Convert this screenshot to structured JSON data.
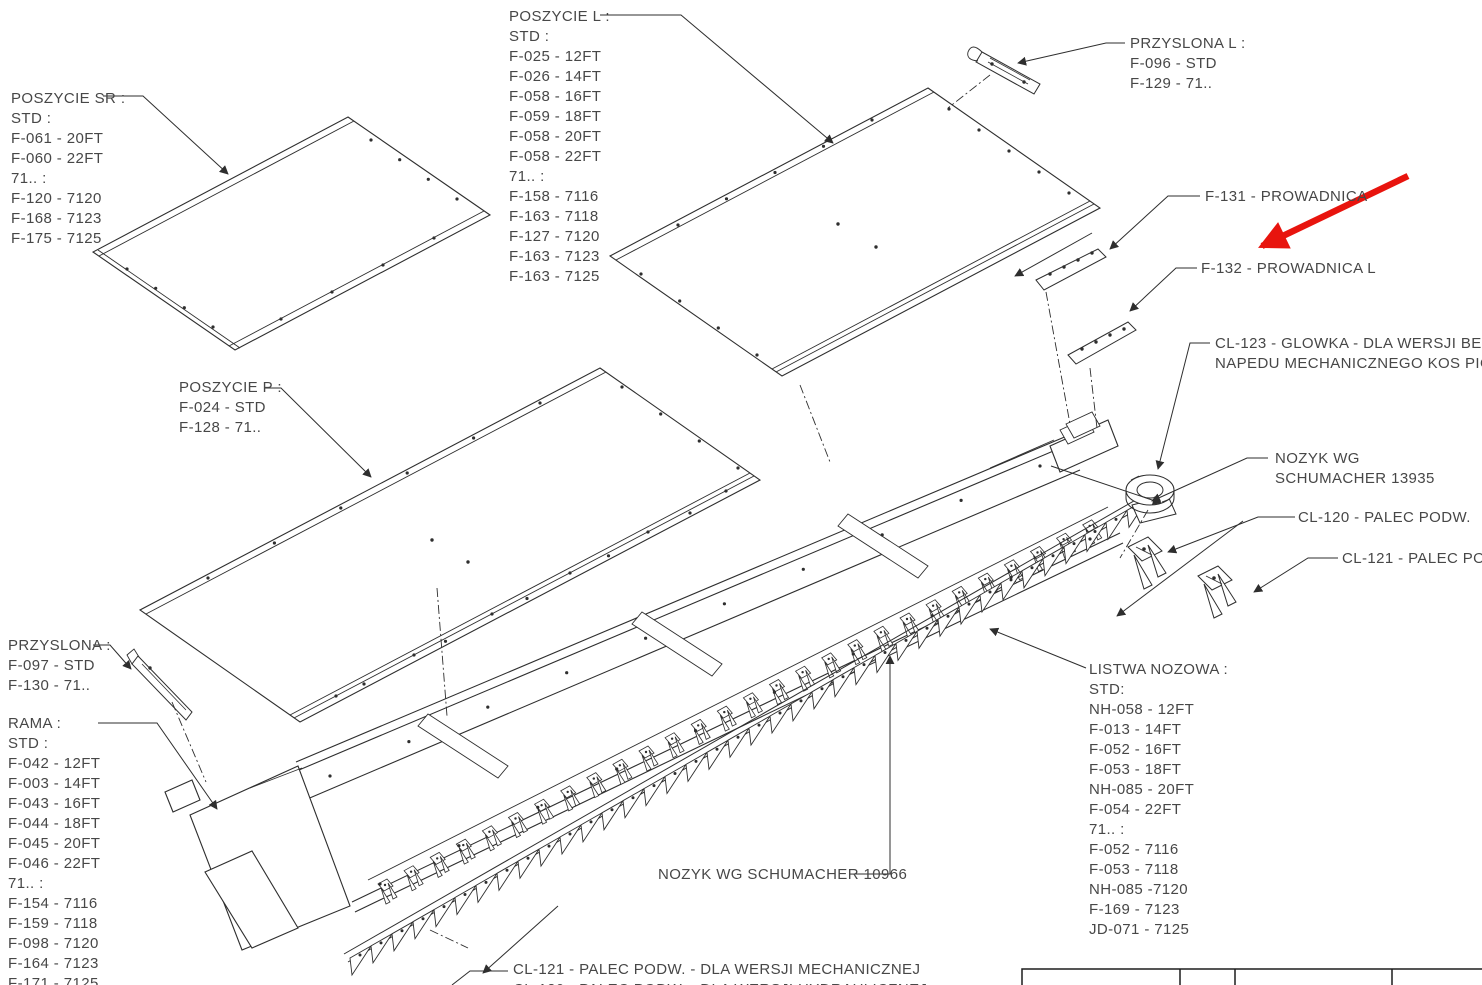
{
  "colors": {
    "line": "#2e2e2e",
    "text": "#474747",
    "highlight_red": "#e8140e",
    "background": "#ffffff"
  },
  "annotation": {
    "red_arrow": "highlight-arrow",
    "points_to": "F-132 - PROWADNICA L"
  },
  "labels": {
    "poszycie_sr": [
      "POSZYCIE SR :",
      "STD :",
      "F-061 - 20FT",
      "F-060 - 22FT",
      "71.. :",
      "F-120 - 7120",
      "F-168 - 7123",
      "F-175 - 7125"
    ],
    "poszycie_l": [
      "POSZYCIE L :",
      "STD :",
      "F-025 - 12FT",
      "F-026 - 14FT",
      "F-058 - 16FT",
      "F-059 - 18FT",
      "F-058 - 20FT",
      "F-058 - 22FT",
      "71.. :",
      "F-158 - 7116",
      "F-163 - 7118",
      "F-127 - 7120",
      "F-163 - 7123",
      "F-163 - 7125"
    ],
    "przyslona_l": [
      "PRZYSLONA L :",
      "F-096 - STD",
      "F-129 - 71.."
    ],
    "f131": [
      "F-131 - PROWADNICA"
    ],
    "f132": [
      "F-132 - PROWADNICA L"
    ],
    "cl123": [
      "CL-123 - GLOWKA - DLA WERSJI BEZ",
      "NAPEDU MECHANICZNEGO KOS PIONOWYCH"
    ],
    "nozyk_13935": [
      "NOZYK WG",
      "SCHUMACHER 13935"
    ],
    "cl120": [
      "CL-120 - PALEC PODW."
    ],
    "cl121": [
      "CL-121 - PALEC PODW."
    ],
    "poszycie_p": [
      "POSZYCIE P :",
      "F-024 - STD",
      "F-128 - 71.."
    ],
    "przyslona": [
      "PRZYSLONA :",
      "F-097 - STD",
      "F-130 - 71.."
    ],
    "rama": [
      "RAMA :",
      "STD :",
      "F-042 - 12FT",
      "F-003 - 14FT",
      "F-043 - 16FT",
      "F-044 - 18FT",
      "F-045 - 20FT",
      "F-046 - 22FT",
      "71.. :",
      "F-154 - 7116",
      "F-159 - 7118",
      "F-098 - 7120",
      "F-164 - 7123",
      "F-171 - 7125"
    ],
    "listwa_nozowa": [
      "LISTWA NOZOWA :",
      "STD:",
      "NH-058 - 12FT",
      "F-013 - 14FT",
      "F-052 - 16FT",
      "F-053 - 18FT",
      "NH-085 - 20FT",
      "F-054 - 22FT",
      "71.. :",
      "F-052 - 7116",
      "F-053 - 7118",
      "NH-085 -7120",
      "F-169 - 7123",
      "JD-071 - 7125"
    ],
    "nozyk_10966": [
      "NOZYK WG SCHUMACHER 10966"
    ],
    "cl121_bottom": [
      "CL-121 - PALEC PODW. - DLA WERSJI MECHANICZNEJ",
      "CL-120 - PALEC PODW. - DLA WERSJI HYDRAULICZNEJ"
    ]
  }
}
